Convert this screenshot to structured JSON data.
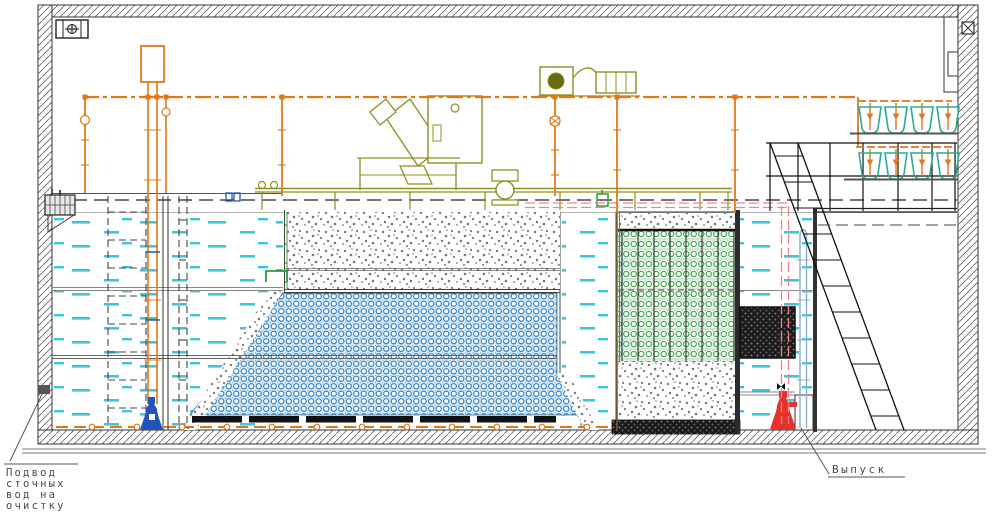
{
  "labels": {
    "inlet": [
      "Подвод",
      "сточных",
      "вод на",
      "очистку"
    ],
    "outlet": "Выпуск"
  },
  "colors": {
    "pipe_orange": "#e07818",
    "water_cyan": "#3cc6de",
    "media_blue": "#2f7ab8",
    "media_green": "#3aa34a",
    "equipment_olive": "#8f8f1f",
    "hopper_teal": "#2aaa96",
    "pump_red": "#e8312a",
    "pump_blue": "#2255bb",
    "pipe_pink": "#f08486",
    "pipe_lightblue": "#8fb0d0",
    "wall_hatch": "#666666",
    "line_dark": "#222222"
  },
  "equipment": {
    "hopper_rows": 2,
    "hoppers_per_row": 4
  }
}
